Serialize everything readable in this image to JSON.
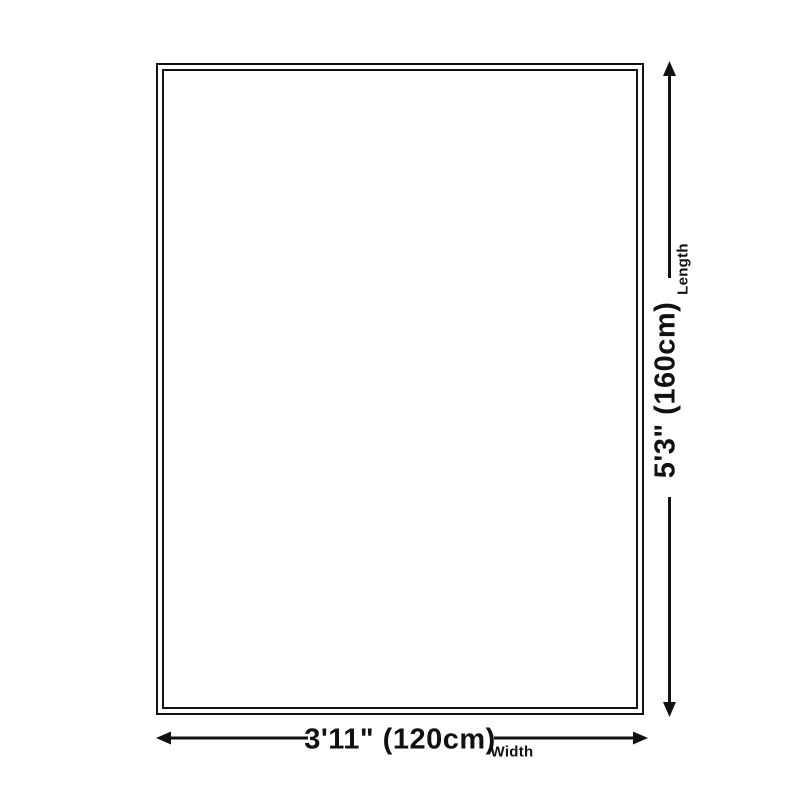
{
  "diagram": {
    "background_color": "#ffffff",
    "line_color": "#111111",
    "length": {
      "value": "5'3\" (160cm)",
      "label": "Length"
    },
    "width": {
      "value": "3'11\" (120cm)",
      "label": "Width"
    }
  }
}
